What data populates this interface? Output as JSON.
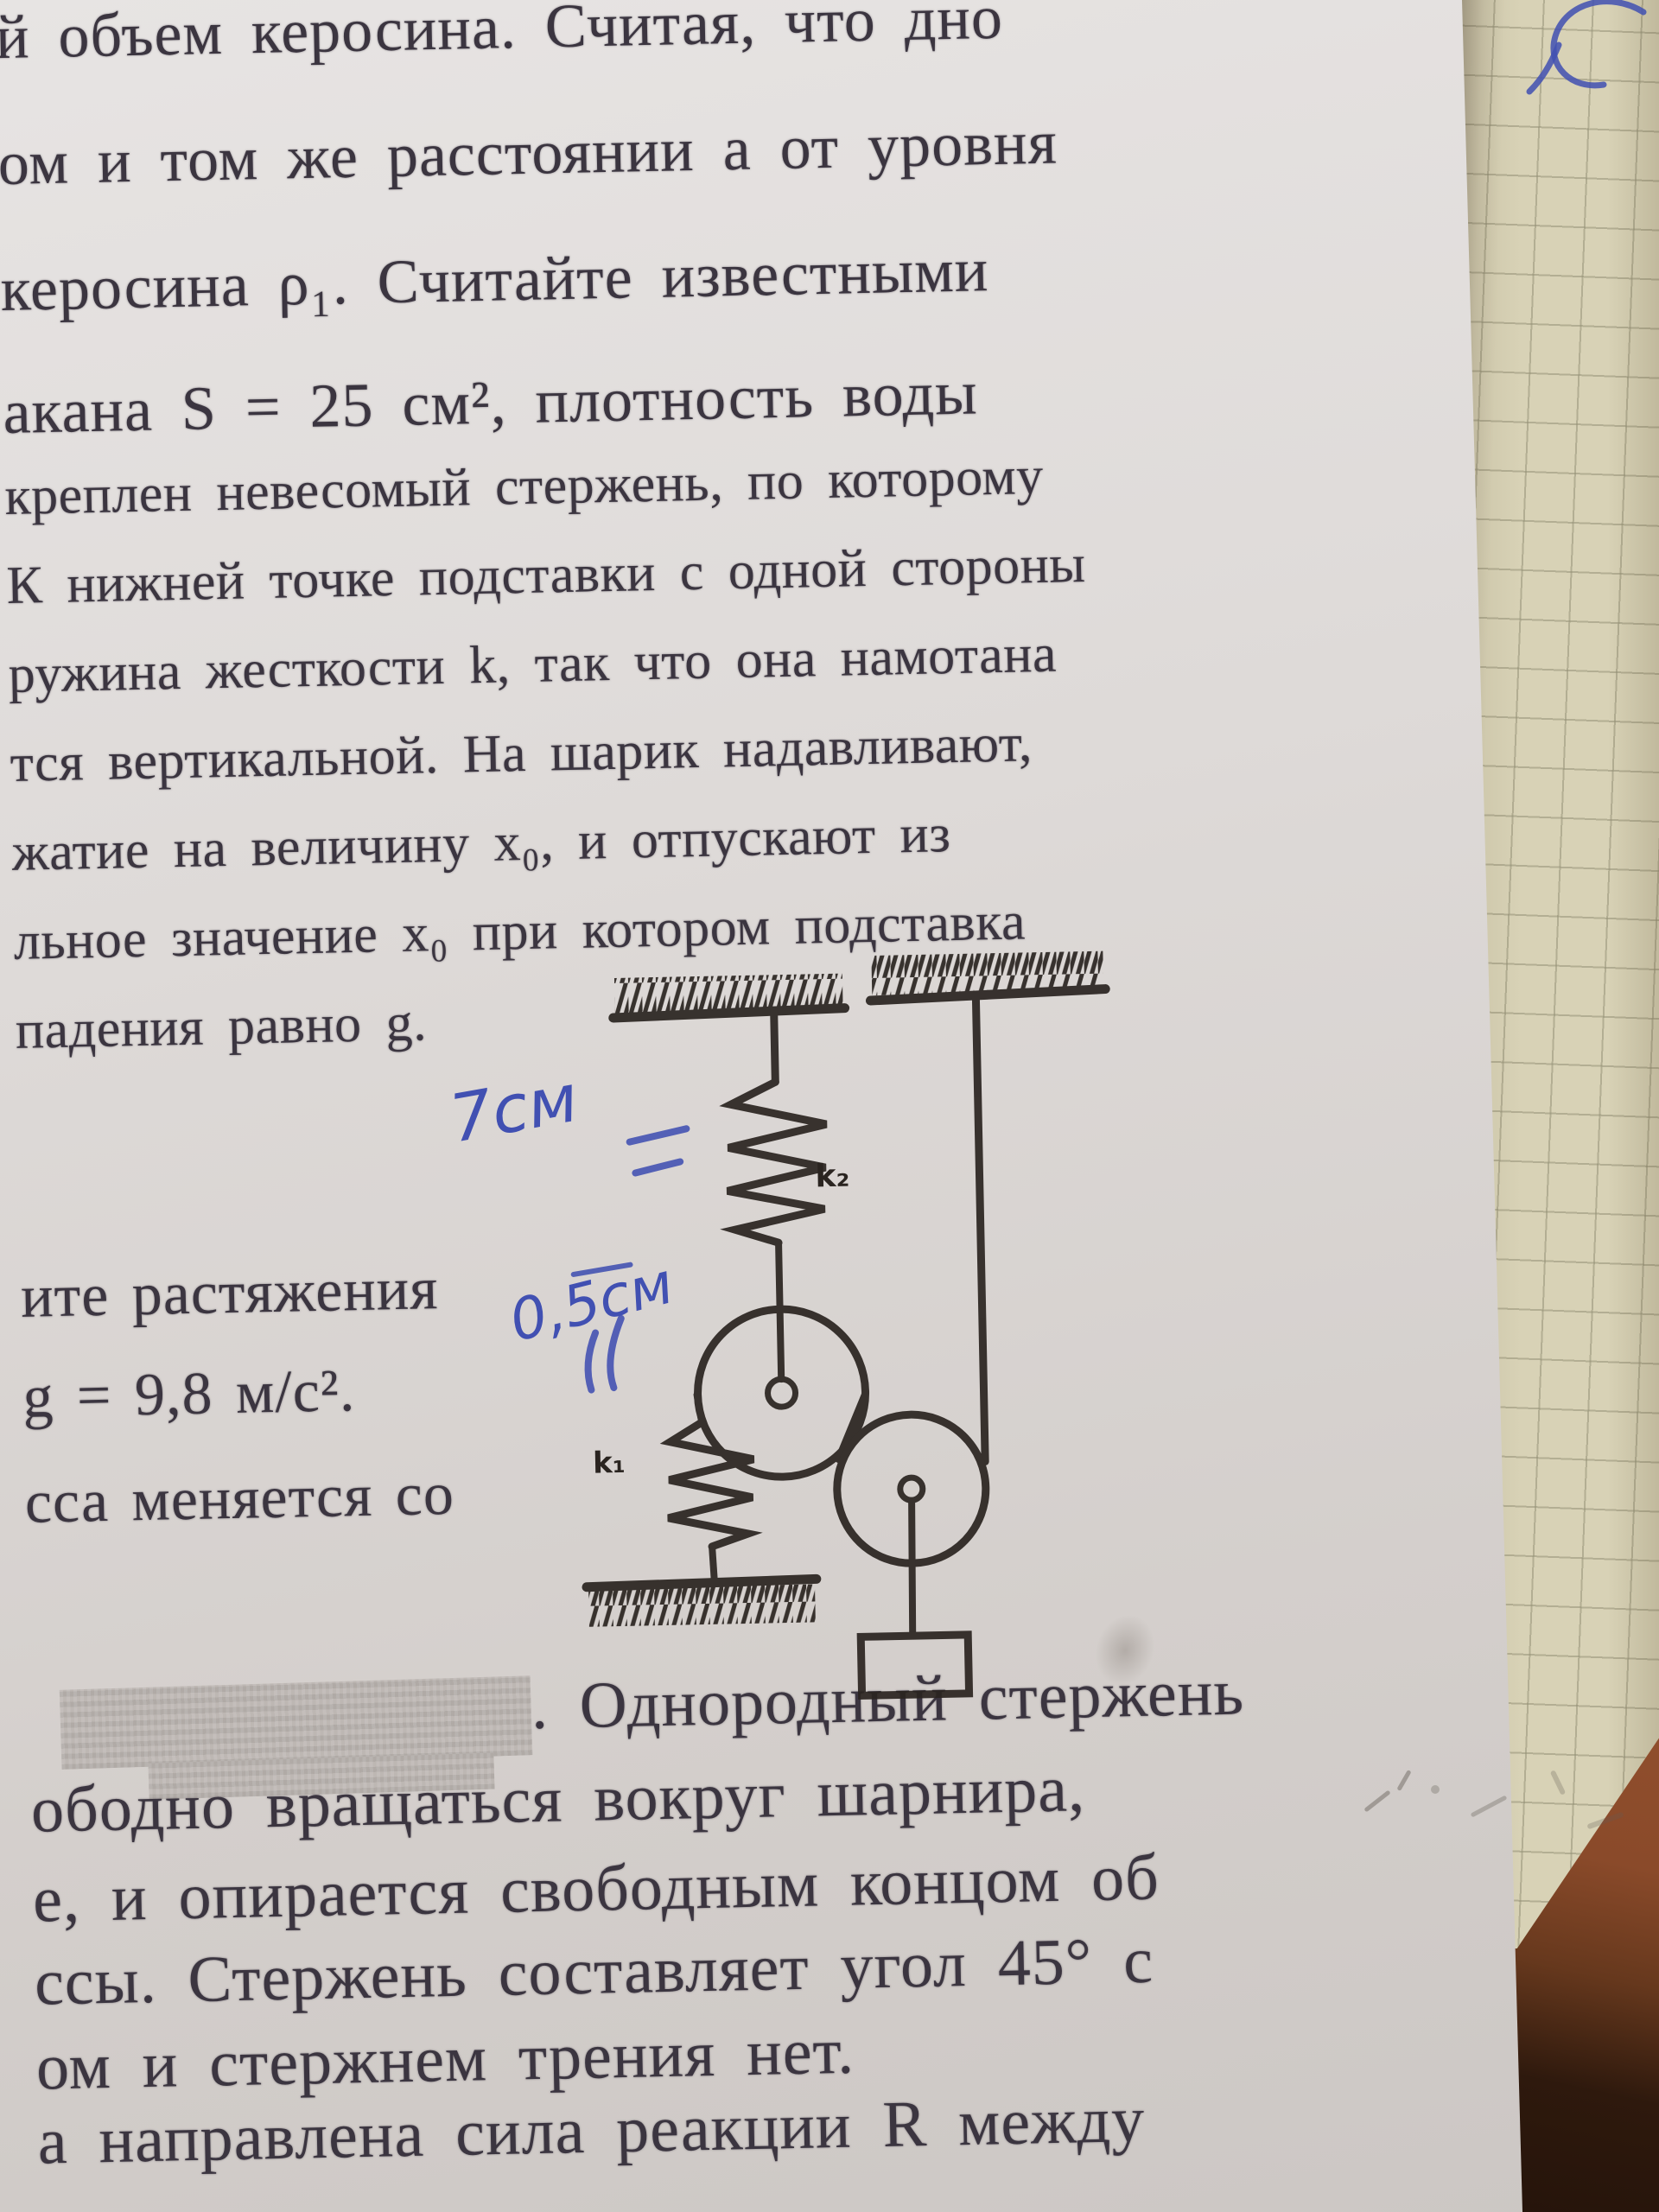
{
  "printed_text": {
    "top_fragment": {
      "lines": [
        "й объем керосина. Считая, что дно",
        "ом и том же расстоянии a от уровня",
        "керосина ρ₁. Считайте известными",
        "акана S = 25 см², плотность воды"
      ]
    },
    "problem_fragment": {
      "lines": [
        "креплен невесомый стержень, по которому",
        "К нижней точке подставки с одной стороны",
        "ружина жесткости k, так что она намотана",
        "тся вертикальной. На шарик надавливают,",
        "жатие на величину x₀, и отпускают из",
        "льное значение x₀ при котором подставка",
        "падения равно g."
      ]
    },
    "side_fragment": {
      "lines": [
        "ите растяжения",
        "g = 9,8 м/с².",
        "сса меняется со"
      ]
    },
    "bottom_fragment": {
      "lines": [
        ". Однородный стержень",
        "ободно вращаться вокруг шарнира,",
        "е, и опирается свободным концом об",
        "ссы. Стержень составляет угол 45° с",
        "ом и стержнем трения нет.",
        "а направлена сила реакции R между"
      ]
    }
  },
  "diagram": {
    "spring_top_label": "k₂",
    "spring_bottom_label": "k₁"
  },
  "handwriting": {
    "length_note_top": "7см",
    "length_note_mid": "0,5см"
  },
  "colors": {
    "ink": "#3b3540",
    "diagram_ink": "#2a2420",
    "pen_blue": "#4150b2",
    "paper": "#ddd8d5",
    "notebook_paper": "#d8d2b6",
    "notebook_grid": "#949076",
    "desk_brown": "#8a4a2a",
    "desk_dark": "#24130a"
  }
}
